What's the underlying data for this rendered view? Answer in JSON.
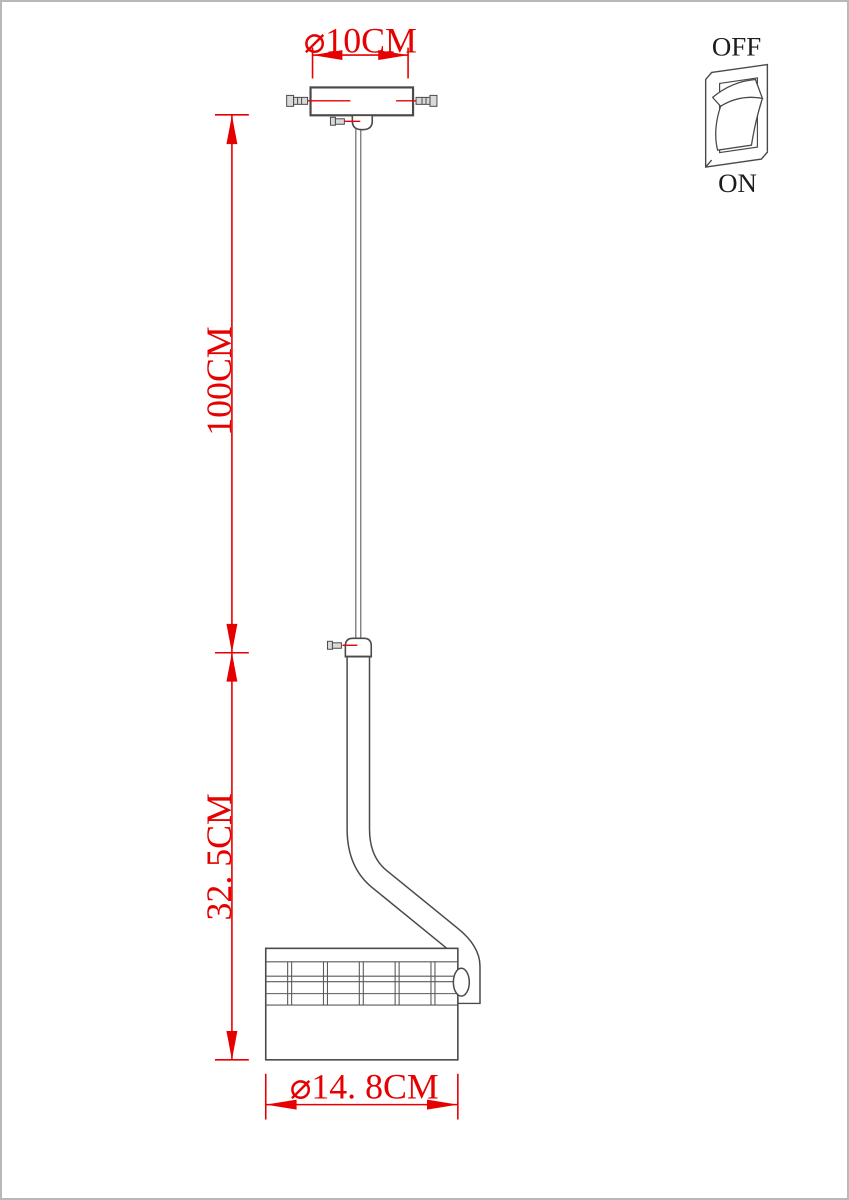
{
  "colors": {
    "dimension_red": "#e60000",
    "drawing_gray": "#4a4a4a",
    "label_black": "#1c1c1c",
    "page_border_gray": "#b8b8b8"
  },
  "dimensions": {
    "canopy_diameter": {
      "label": "⌀10CM"
    },
    "cord_length": {
      "label": "100CM"
    },
    "fixture_height": {
      "label": "32. 5CM"
    },
    "shade_diameter": {
      "label": "⌀14. 8CM"
    }
  },
  "switch": {
    "off_label": "OFF",
    "on_label": "ON"
  }
}
